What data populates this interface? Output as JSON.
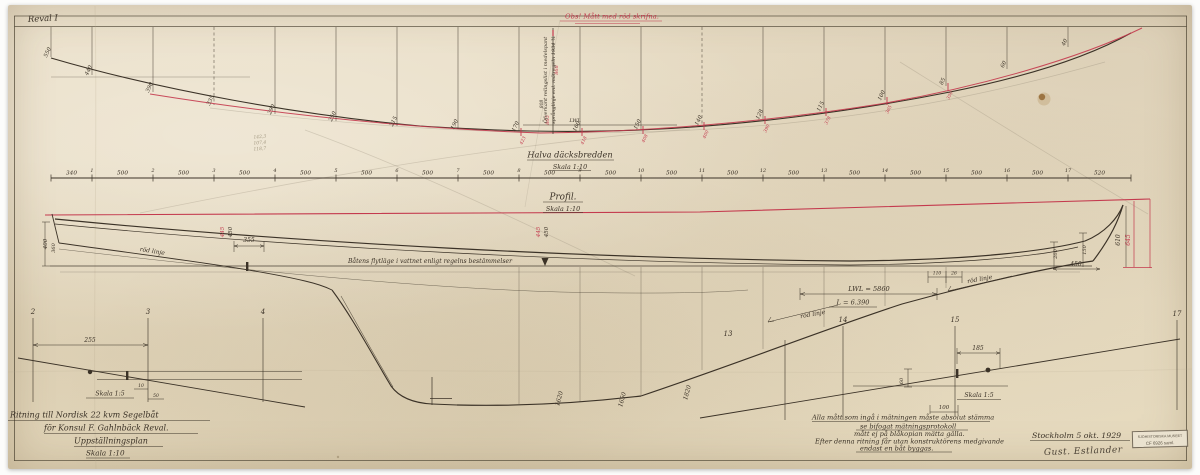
{
  "sheet": {
    "corner_mark": "Reval I",
    "red_note": "Obs! Mått med röd skrifna.",
    "rotated_note_line1": "Öfverkant relingslist i medelspant",
    "rotated_note_line2": "språnglinje enl. mätregeln 1934 ¾",
    "colors": {
      "paper": "#e9dfc7",
      "ink": "#3b3227",
      "red": "#c43a4e"
    }
  },
  "plan": {
    "title": "Halva däcksbredden",
    "scale": "Skala 1:10",
    "lwl_label": "LWL",
    "curve_values": [
      "550",
      "440",
      "390",
      "335",
      "290",
      "250",
      "215",
      "190",
      "170",
      "160",
      "150",
      "140",
      "128",
      "115",
      "100",
      "85",
      "60",
      "40"
    ],
    "curve_values_red": [
      "423",
      "418",
      "408",
      "400",
      "390",
      "378",
      "365",
      "350"
    ],
    "curve_values_red_start_station": 8
  },
  "ruler": {
    "first_segment": "340",
    "segment": "500",
    "last_segment": "520",
    "station_numbers": [
      "1",
      "2",
      "3",
      "4",
      "5",
      "6",
      "7",
      "8",
      "9",
      "10",
      "11",
      "12",
      "13",
      "14",
      "15",
      "16",
      "17"
    ]
  },
  "profile": {
    "title": "Profil.",
    "scale": "Skala 1:10",
    "waterline_note": "Båtens flytläge i vattnet enligt regelns bestämmelser",
    "lwl_dimension": "LWL = 5860",
    "length_dimension": "L = 6.390"
  },
  "details": {
    "left_scale": "Skala 1:5",
    "right_scale": "Skala 1:5"
  },
  "title_block": {
    "line1": "Ritning till Nordisk 22 kvm Segelbåt",
    "line2": "för Konsul F. Gahlnbäck Reval.",
    "line3": "Uppställningsplan",
    "line4": "Skala 1:10"
  },
  "notes_block": {
    "line1": "Alla mått som ingå i mätningen måste absolut stämma",
    "line2": "se bifogat mätningsprotokoll",
    "line3": "mått ej på blåkopian mätta gälla.",
    "line4": "Efter denna ritning får utan konstruktörens medgivande",
    "line5": "endast en båt byggas."
  },
  "signature": {
    "place_date": "Stockholm 5 okt. 1929",
    "name": "Gust. Estlander"
  },
  "stamp": {
    "line1": "SJÖHISTORISKA MUSEET",
    "line2": "CF 6926 saml."
  },
  "annotations": [
    {
      "t": "röd linje",
      "x": 152,
      "y": 253,
      "r": 9,
      "s": 6
    },
    {
      "t": "röd linje",
      "x": 813,
      "y": 316,
      "r": -10,
      "s": 6
    },
    {
      "t": "röd linje",
      "x": 980,
      "y": 281,
      "r": -10,
      "s": 6
    },
    {
      "t": "445",
      "x": 224,
      "y": 232,
      "r": -90,
      "s": 5.5,
      "c": "red"
    },
    {
      "t": "450",
      "x": 232,
      "y": 232,
      "r": -90,
      "s": 5.5
    },
    {
      "t": "445",
      "x": 540,
      "y": 232,
      "r": -90,
      "s": 5.5,
      "c": "red"
    },
    {
      "t": "450",
      "x": 548,
      "y": 232,
      "r": -90,
      "s": 5.5
    },
    {
      "t": "355",
      "x": 249,
      "y": 242,
      "s": 6
    },
    {
      "t": "400",
      "x": 47,
      "y": 244,
      "r": -90,
      "s": 5.5
    },
    {
      "t": "360",
      "x": 55,
      "y": 248,
      "r": -90,
      "s": 5
    },
    {
      "t": "110",
      "x": 937,
      "y": 274.5,
      "s": 4.5
    },
    {
      "t": "26",
      "x": 954,
      "y": 274.5,
      "s": 4.5
    },
    {
      "t": "610",
      "x": 1120,
      "y": 240,
      "r": -90,
      "s": 6
    },
    {
      "t": "645",
      "x": 1130,
      "y": 240,
      "r": -90,
      "s": 6,
      "c": "red"
    },
    {
      "t": "450",
      "x": 1076,
      "y": 266,
      "s": 6
    },
    {
      "t": "150",
      "x": 1086,
      "y": 250,
      "r": -90,
      "s": 5
    },
    {
      "t": "200",
      "x": 1057,
      "y": 254,
      "r": -90,
      "s": 5
    },
    {
      "t": "1620",
      "x": 561,
      "y": 399,
      "r": -75,
      "s": 6
    },
    {
      "t": "1650",
      "x": 624,
      "y": 400,
      "r": -75,
      "s": 6
    },
    {
      "t": "1820",
      "x": 689,
      "y": 393,
      "r": -75,
      "s": 6
    },
    {
      "t": "13",
      "x": 728,
      "y": 336,
      "s": 7
    },
    {
      "t": "14",
      "x": 843,
      "y": 322,
      "s": 7
    },
    {
      "t": "15",
      "x": 955,
      "y": 322,
      "s": 7
    },
    {
      "t": "17",
      "x": 1177,
      "y": 316,
      "s": 7
    },
    {
      "t": "2",
      "x": 33,
      "y": 314,
      "s": 7
    },
    {
      "t": "3",
      "x": 148,
      "y": 314,
      "s": 7
    },
    {
      "t": "4",
      "x": 263,
      "y": 314,
      "s": 7
    },
    {
      "t": "255",
      "x": 90,
      "y": 342,
      "s": 6
    },
    {
      "t": "10",
      "x": 141,
      "y": 387,
      "s": 4.5
    },
    {
      "t": "50",
      "x": 156,
      "y": 397,
      "s": 4.5
    },
    {
      "t": "185",
      "x": 978,
      "y": 350,
      "s": 6
    },
    {
      "t": "60",
      "x": 903,
      "y": 381,
      "r": -90,
      "s": 5
    },
    {
      "t": "100",
      "x": 944,
      "y": 409,
      "s": 5.5
    },
    {
      "t": "142,3",
      "x": 260,
      "y": 138,
      "r": -5,
      "s": 4.5,
      "c": "pencil"
    },
    {
      "t": "107,4",
      "x": 260,
      "y": 144,
      "r": -5,
      "s": 4.5,
      "c": "pencil"
    },
    {
      "t": "118,7",
      "x": 260,
      "y": 150,
      "r": -5,
      "s": 4.5,
      "c": "pencil"
    },
    {
      "t": "868",
      "x": 558,
      "y": 70,
      "r": -90,
      "s": 5,
      "c": "red"
    },
    {
      "t": "865",
      "x": 549,
      "y": 120,
      "r": -90,
      "s": 5,
      "c": "red"
    },
    {
      "t": "808",
      "x": 543,
      "y": 104,
      "r": -90,
      "s": 4.5
    },
    {
      "t": "LWL",
      "x": 575,
      "y": 122,
      "s": 5
    }
  ]
}
